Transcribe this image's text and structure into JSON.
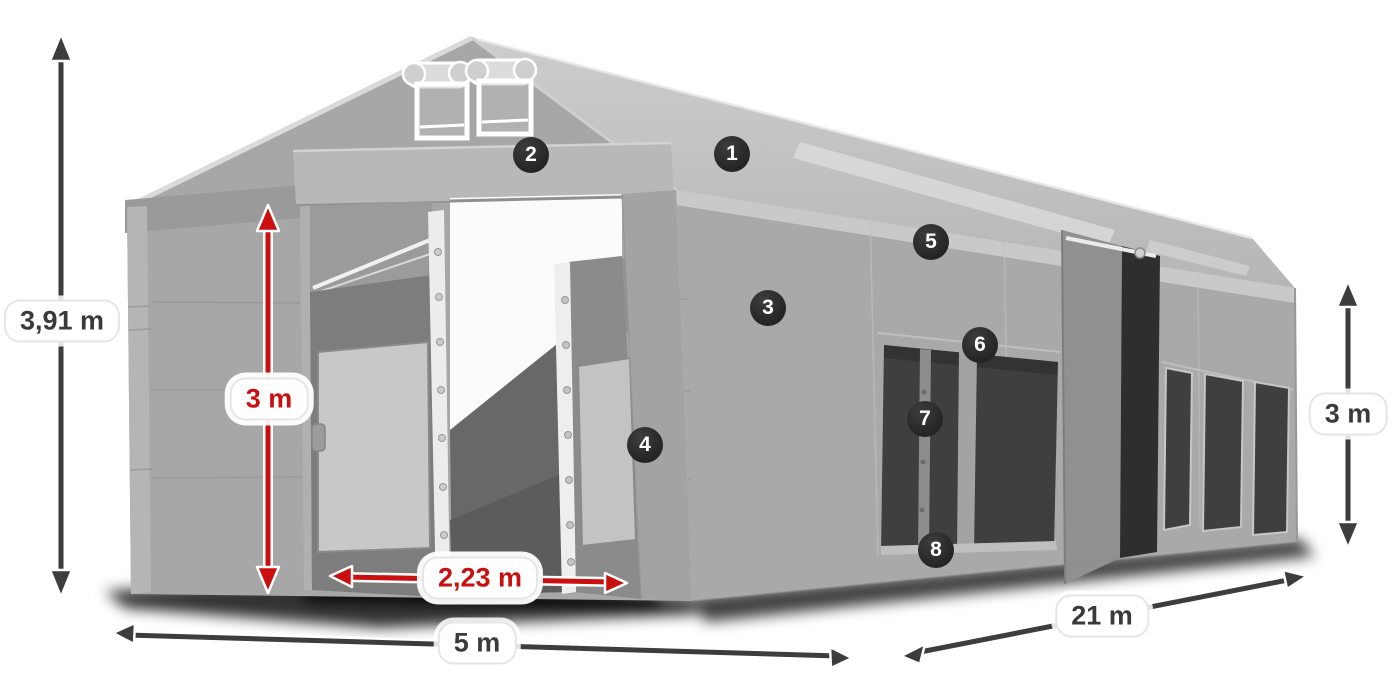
{
  "diagram": {
    "name": "tent-dimension-diagram",
    "subject": "Gray marquee storage tent with dimension arrows and numbered feature callouts"
  },
  "dims": {
    "total_height": {
      "label": "3,91 m",
      "style": "dark"
    },
    "door_height": {
      "label": "3 m",
      "style": "red"
    },
    "door_width": {
      "label": "2,23 m",
      "style": "red"
    },
    "tent_width": {
      "label": "5 m",
      "style": "dark"
    },
    "tent_length": {
      "label": "21 m",
      "style": "dark"
    },
    "side_height": {
      "label": "3 m",
      "style": "dark"
    }
  },
  "badges": {
    "items": [
      {
        "number": "1",
        "x": 732,
        "y": 154
      },
      {
        "number": "2",
        "x": 531,
        "y": 155
      },
      {
        "number": "3",
        "x": 768,
        "y": 308
      },
      {
        "number": "4",
        "x": 645,
        "y": 445
      },
      {
        "number": "5",
        "x": 931,
        "y": 242
      },
      {
        "number": "6",
        "x": 980,
        "y": 345
      },
      {
        "number": "7",
        "x": 925,
        "y": 419
      },
      {
        "number": "8",
        "x": 936,
        "y": 550
      }
    ]
  },
  "colors": {
    "badge_bg": "#242424",
    "badge_text": "#ffffff",
    "dim_arrow": "#3d3d3d",
    "red_arrow": "#c90f0f",
    "label_bg": "#ffffff",
    "label_text": "#3a3a3a",
    "label_border": "#e6e6e6"
  }
}
